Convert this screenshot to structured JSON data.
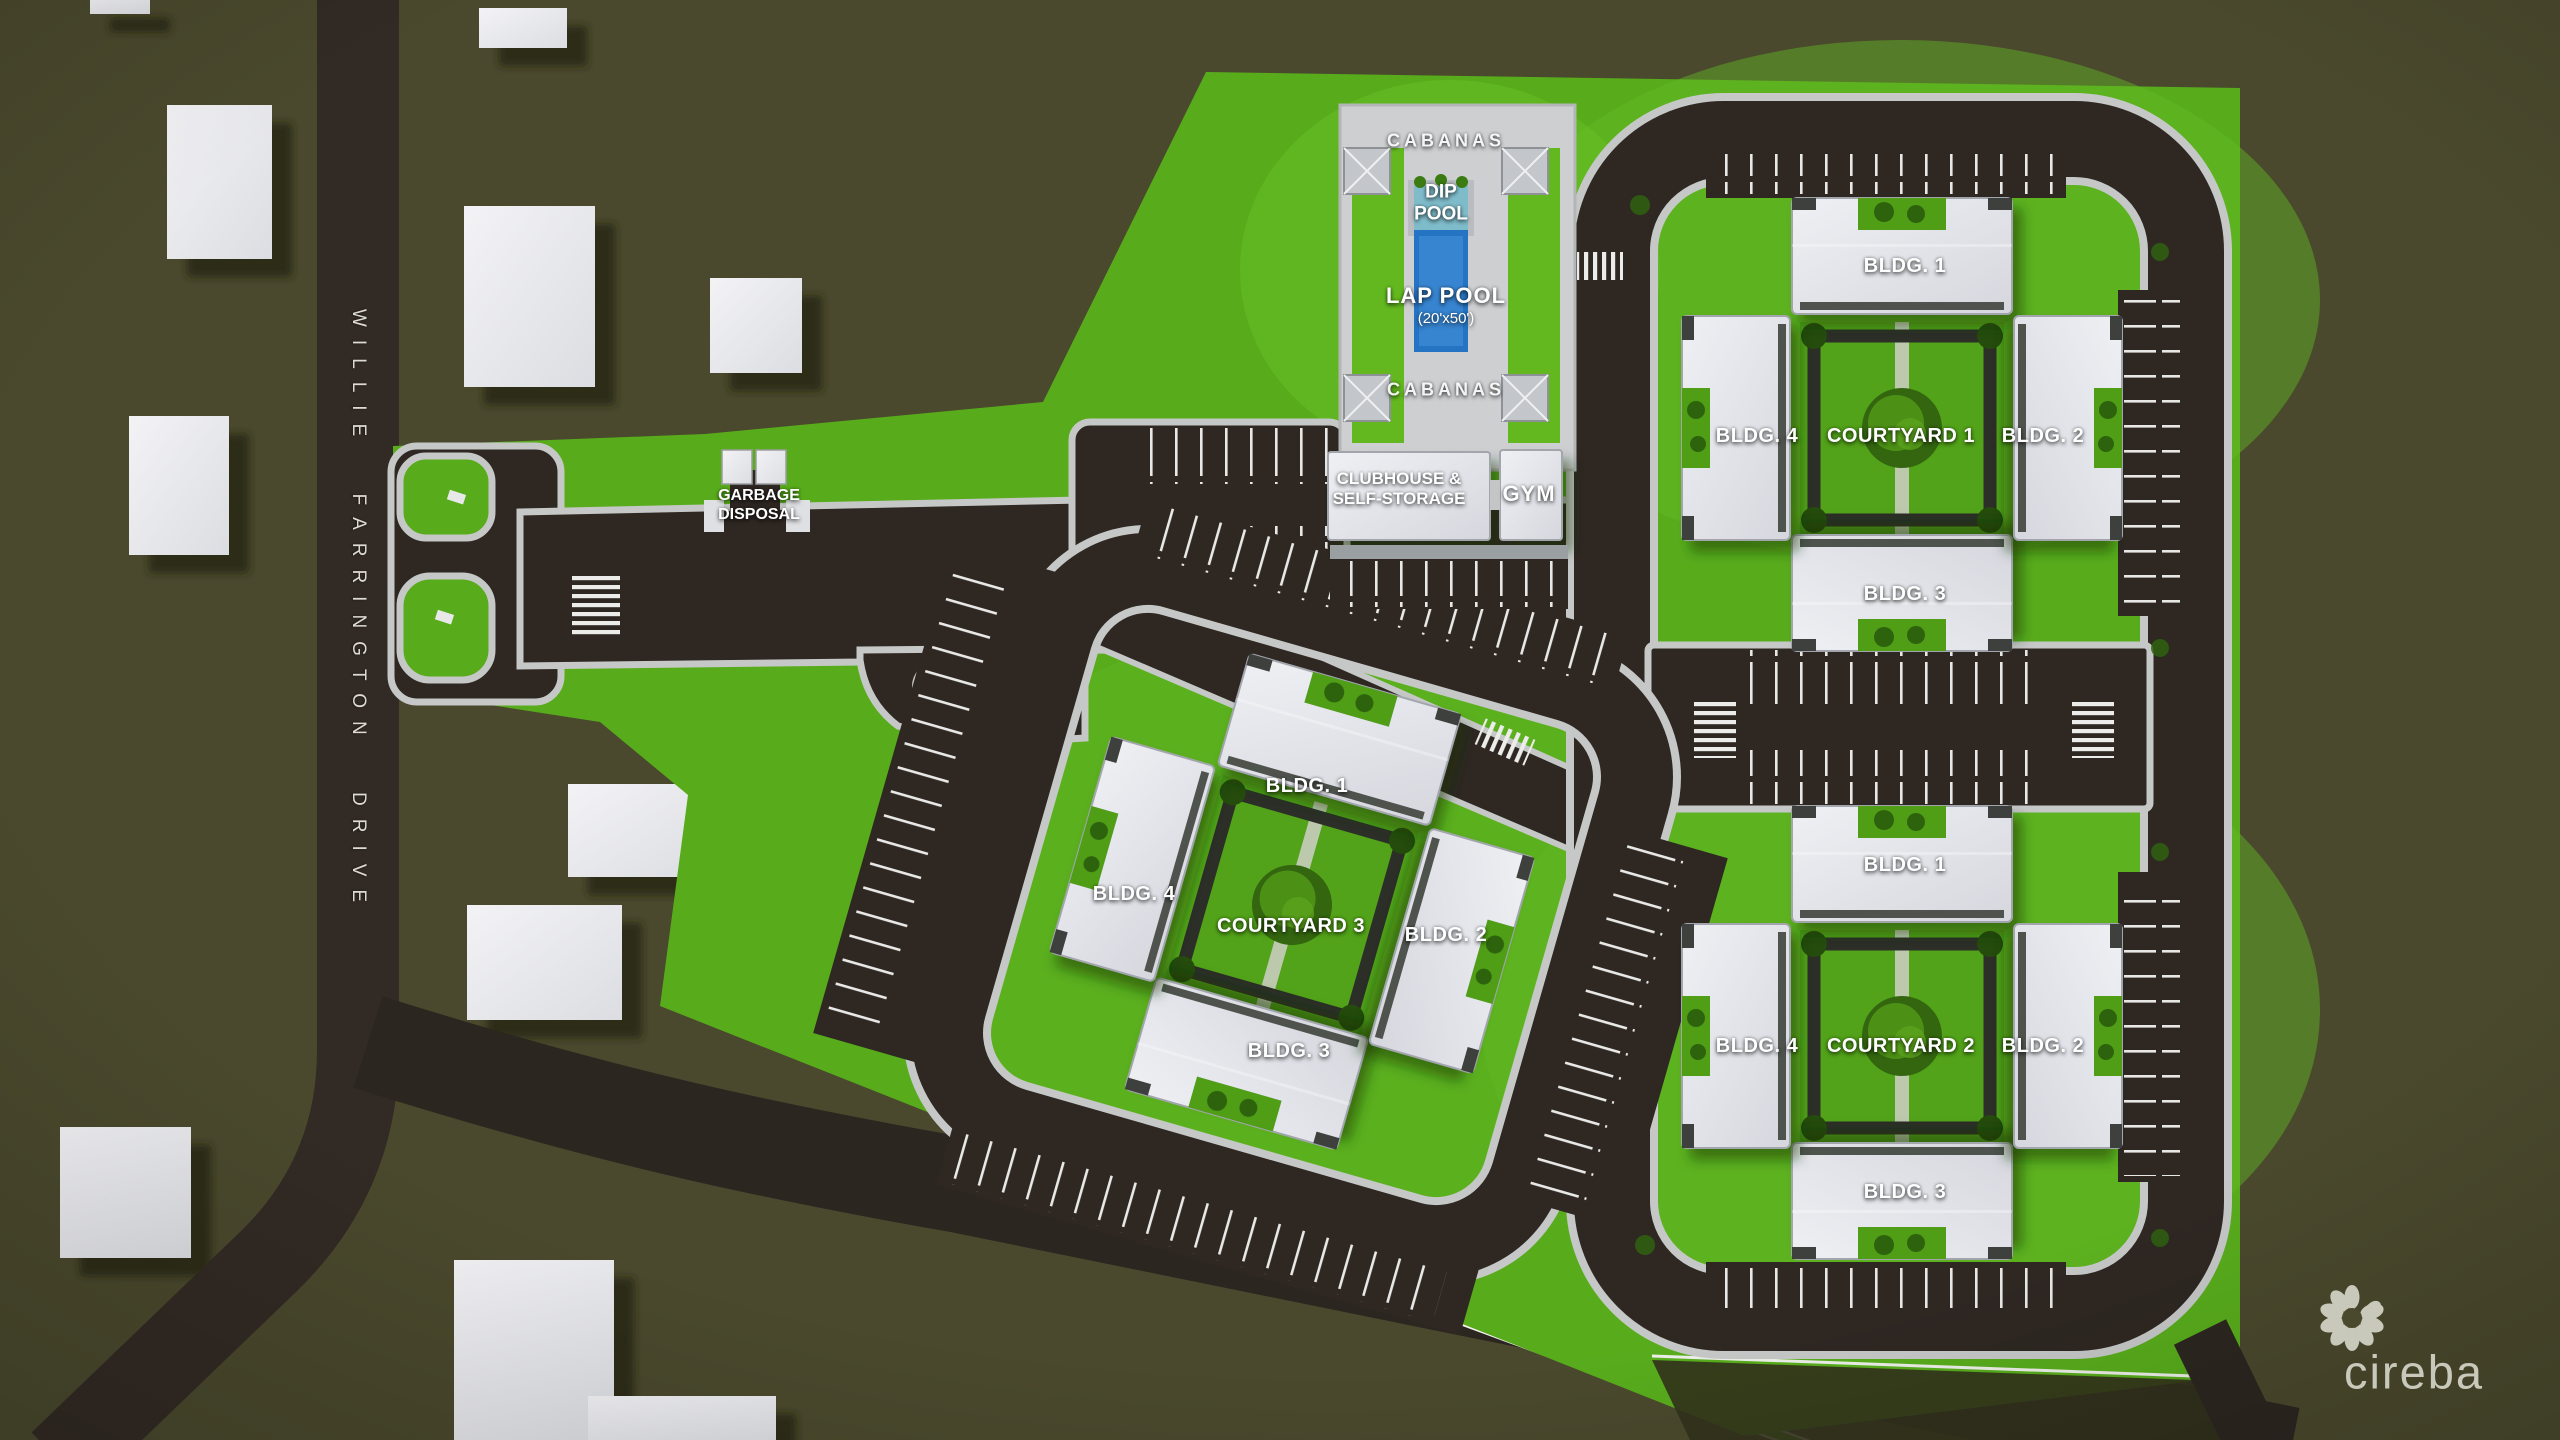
{
  "map": {
    "street_label": "WILLIE FARRINGTON DRIVE",
    "garbage_label": "GARBAGE DISPOSAL",
    "amenities": {
      "cabanas_top": "CABANAS",
      "cabanas_bottom": "CABANAS",
      "dip_pool": "DIP POOL",
      "lap_pool": "LAP POOL",
      "lap_pool_size": "(20'x50')",
      "clubhouse": "CLUBHOUSE & SELF-STORAGE",
      "gym": "GYM"
    },
    "clusters": [
      {
        "courtyard_label": "COURTYARD 1",
        "buildings": [
          "BLDG. 1",
          "BLDG. 2",
          "BLDG. 3",
          "BLDG. 4"
        ]
      },
      {
        "courtyard_label": "COURTYARD 2",
        "buildings": [
          "BLDG. 1",
          "BLDG. 2",
          "BLDG. 3",
          "BLDG. 4"
        ]
      },
      {
        "courtyard_label": "COURTYARD 3",
        "buildings": [
          "BLDG. 1",
          "BLDG. 2",
          "BLDG. 3",
          "BLDG. 4"
        ]
      }
    ],
    "branding": {
      "logo_text": "cireba",
      "logo_icon": "flower-petal-ring-icon"
    },
    "colors": {
      "background_olive": "#4a492d",
      "site_green": "#58ac1c",
      "courtyard_green": "#52a319",
      "asphalt": "#2e2722",
      "sidewalk": "#c6c8c8",
      "building": "#e3e4e9",
      "lap_pool_blue": "#2e7cc9",
      "dip_pool_teal": "#7fbcca",
      "label_white": "#ffffff",
      "logo_gray": "#c9c9bb"
    }
  }
}
